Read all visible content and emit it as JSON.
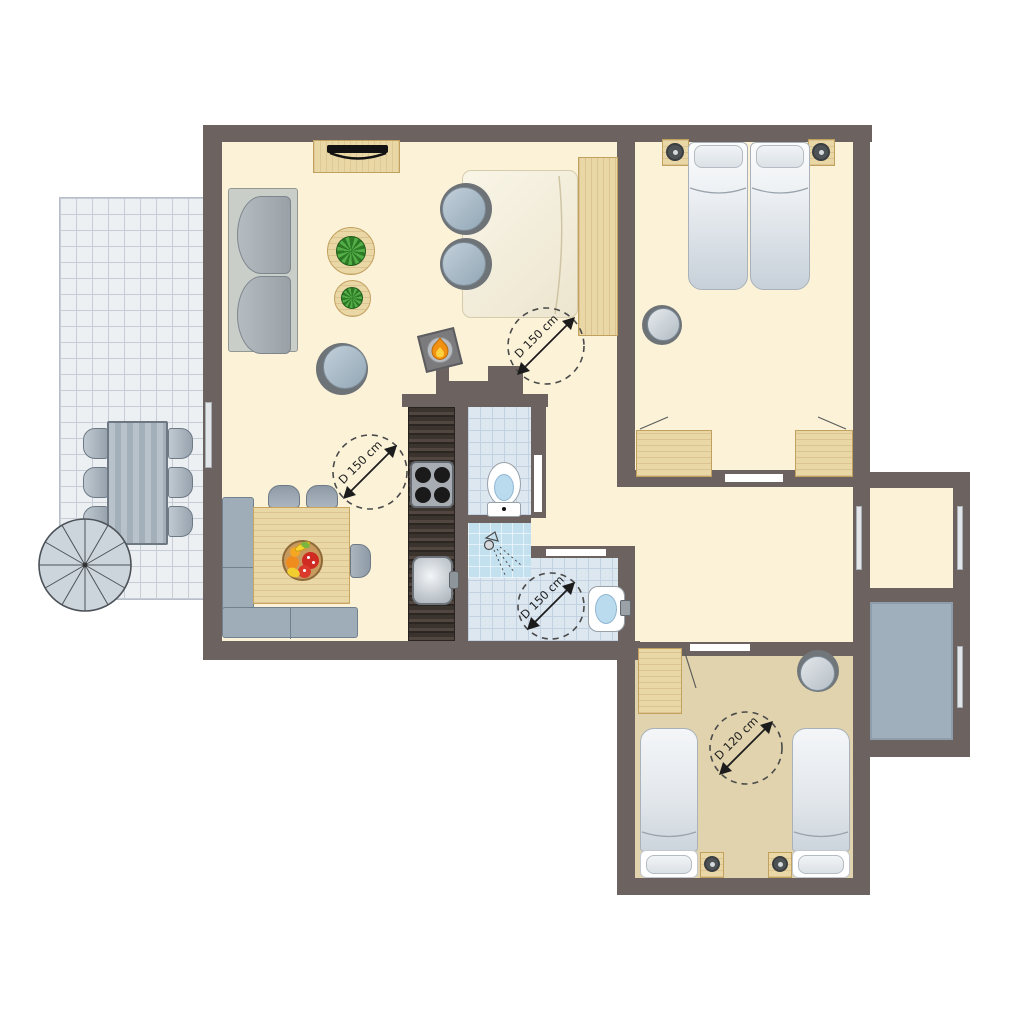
{
  "palette": {
    "paper": "#ffffff",
    "wall": "#6c6360",
    "floorCream": "#fbf2d8",
    "floorTan": "#e0d3ad",
    "tile": "#dde7f0",
    "tileLine": "#c3d2e2",
    "shower": "#c3e0ef",
    "balcony": "#9fb0bc",
    "terrace": "#edf0f3",
    "terraceLine": "#c6cdd6",
    "wood": "#ead7a6",
    "woodEdge": "#c2a05e",
    "ink": "#1c1c1c",
    "flameOrange": "#f29111",
    "flameYellow": "#ffd23f",
    "fruitRed": "#cf2b22",
    "fruitOrange": "#f08c1e",
    "fruitYellow": "#f7d22e"
  },
  "annotations": {
    "turning_circles": [
      {
        "label": "D 150 cm",
        "location": "living-room-bed"
      },
      {
        "label": "D 150 cm",
        "location": "kitchen-dining"
      },
      {
        "label": "D 150 cm",
        "location": "bathroom"
      },
      {
        "label": "D 120 cm",
        "location": "twin-bedroom"
      }
    ]
  },
  "building": {
    "rooms": [
      {
        "name": "living-room",
        "floor": "cream"
      },
      {
        "name": "kitchen",
        "floor": "cream"
      },
      {
        "name": "toilet-room",
        "floor": "tiles"
      },
      {
        "name": "shower-bathroom",
        "floor": "tiles"
      },
      {
        "name": "hallway",
        "floor": "cream"
      },
      {
        "name": "double-bedroom",
        "floor": "cream"
      },
      {
        "name": "storage-room",
        "floor": "cream"
      },
      {
        "name": "balcony",
        "floor": "gray"
      },
      {
        "name": "twin-bedroom",
        "floor": "tan"
      },
      {
        "name": "terrace",
        "floor": "tile-grid"
      }
    ],
    "furniture_icons": [
      "sofa",
      "tv-sideboard",
      "round-plant-table",
      "tub-armchair",
      "double-bed",
      "headboard-panel",
      "wood-stove",
      "corner-bench",
      "dining-table",
      "fruit-bowl",
      "dining-chair",
      "kitchen-counter",
      "cooktop",
      "kitchen-sink",
      "toilet",
      "shower-head",
      "washbasin",
      "nightstand-with-lamp",
      "twin-mattress",
      "wardrobe",
      "closet",
      "round-side-table",
      "spiral-staircase",
      "garden-table",
      "garden-chair",
      "window-opening",
      "door-opening"
    ]
  }
}
